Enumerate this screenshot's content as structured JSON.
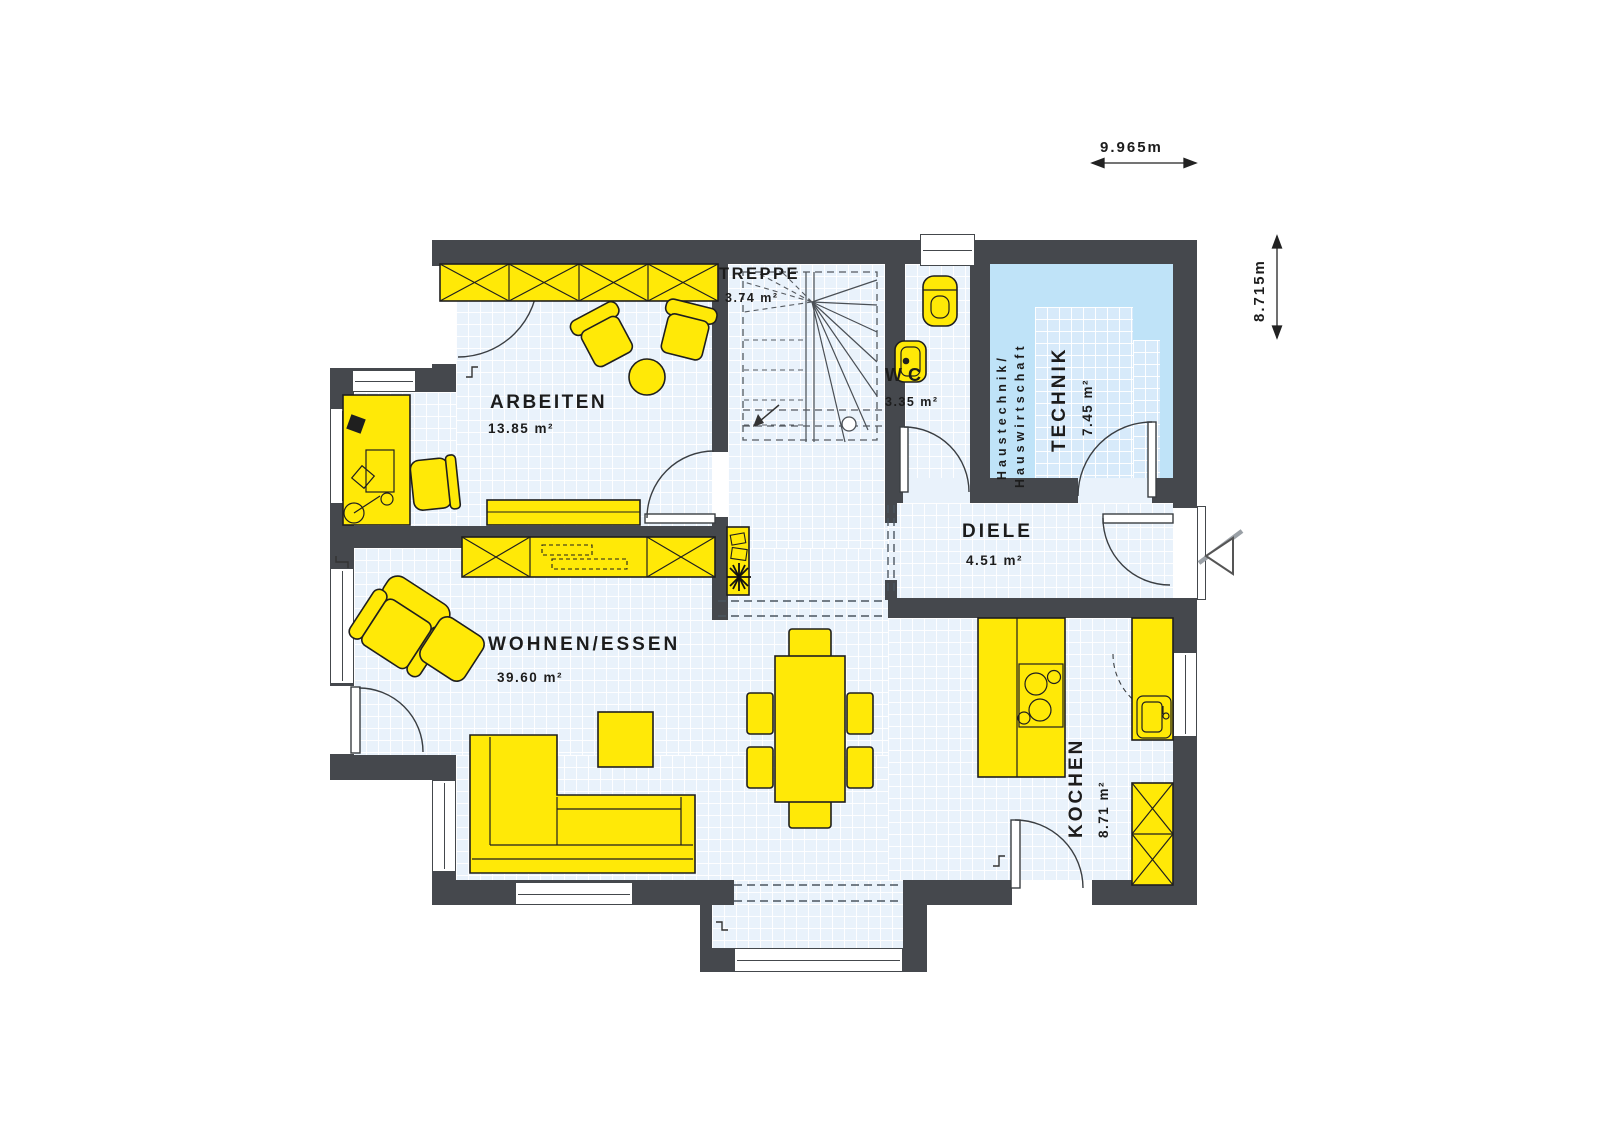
{
  "plan": {
    "dimensions": {
      "width_label": "9.965m",
      "height_label": "8.715m"
    },
    "rooms": {
      "arbeiten": {
        "name": "ARBEITEN",
        "area": "13.85 m²"
      },
      "treppe": {
        "name": "TREPPE",
        "area": "3.74 m²"
      },
      "wc": {
        "name": "WC",
        "area": "3.35 m²"
      },
      "technik": {
        "name": "TECHNIK",
        "area": "7.45 m²",
        "note_line1": "Haustechnik/",
        "note_line2": "Hauswirtschaft"
      },
      "diele": {
        "name": "DIELE",
        "area": "4.51 m²"
      },
      "wohnen_essen": {
        "name": "WOHNEN/ESSEN",
        "area": "39.60 m²"
      },
      "kochen": {
        "name": "KOCHEN",
        "area": "8.71 m²"
      }
    },
    "colors": {
      "wall": "#45484d",
      "floor": "#e9f2fb",
      "technik_zone": "#bfe3f8",
      "technik_floor": "#d7eafa",
      "furniture": "#ffe907",
      "text": "#1c1c1c"
    }
  }
}
